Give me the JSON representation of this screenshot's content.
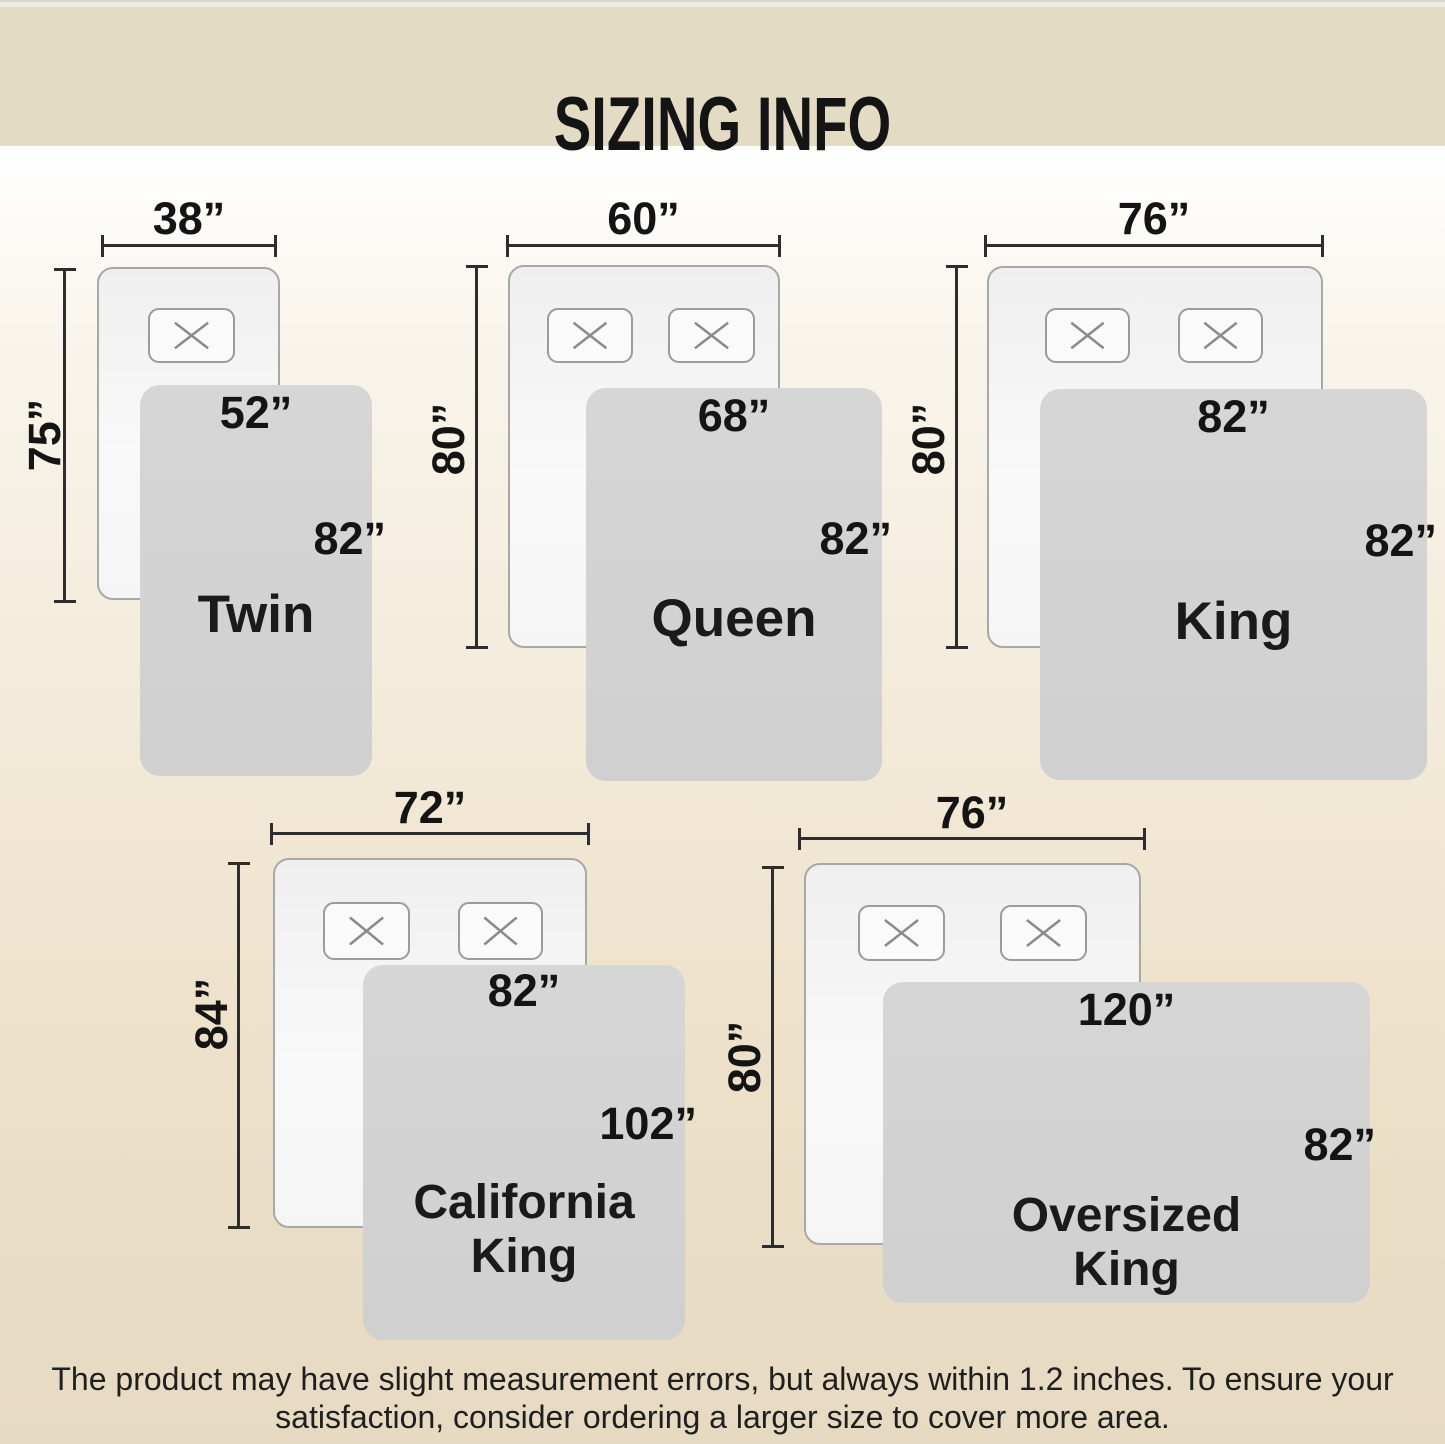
{
  "header": {
    "title": "SIZING INFO"
  },
  "sizes": [
    {
      "name": "Twin",
      "bed_width": "38”",
      "bed_length": "75”",
      "blanket_width": "52”",
      "blanket_length": "82”",
      "pillows": 1
    },
    {
      "name": "Queen",
      "bed_width": "60”",
      "bed_length": "80”",
      "blanket_width": "68”",
      "blanket_length": "82”",
      "pillows": 2
    },
    {
      "name": "King",
      "bed_width": "76”",
      "bed_length": "80”",
      "blanket_width": "82”",
      "blanket_length": "82”",
      "pillows": 2
    },
    {
      "name": "California King",
      "bed_width": "72”",
      "bed_length": "84”",
      "blanket_width": "82”",
      "blanket_length": "102”",
      "pillows": 2
    },
    {
      "name": "Oversized King",
      "bed_width": "76”",
      "bed_length": "80”",
      "blanket_width": "120”",
      "blanket_length": "82”",
      "pillows": 2
    }
  ],
  "footer": {
    "line1": "The product may have slight measurement errors, but always within 1.2 inches. To ensure your",
    "line2": "satisfaction, consider ordering a larger size to cover more area."
  },
  "colors": {
    "header_band": "#e4dbc5",
    "background_bottom": "#e7dac3",
    "blanket_fill": "#d3d3d3",
    "bed_fill": "#f7f7f7",
    "dimension_line": "#2d2d2d"
  }
}
